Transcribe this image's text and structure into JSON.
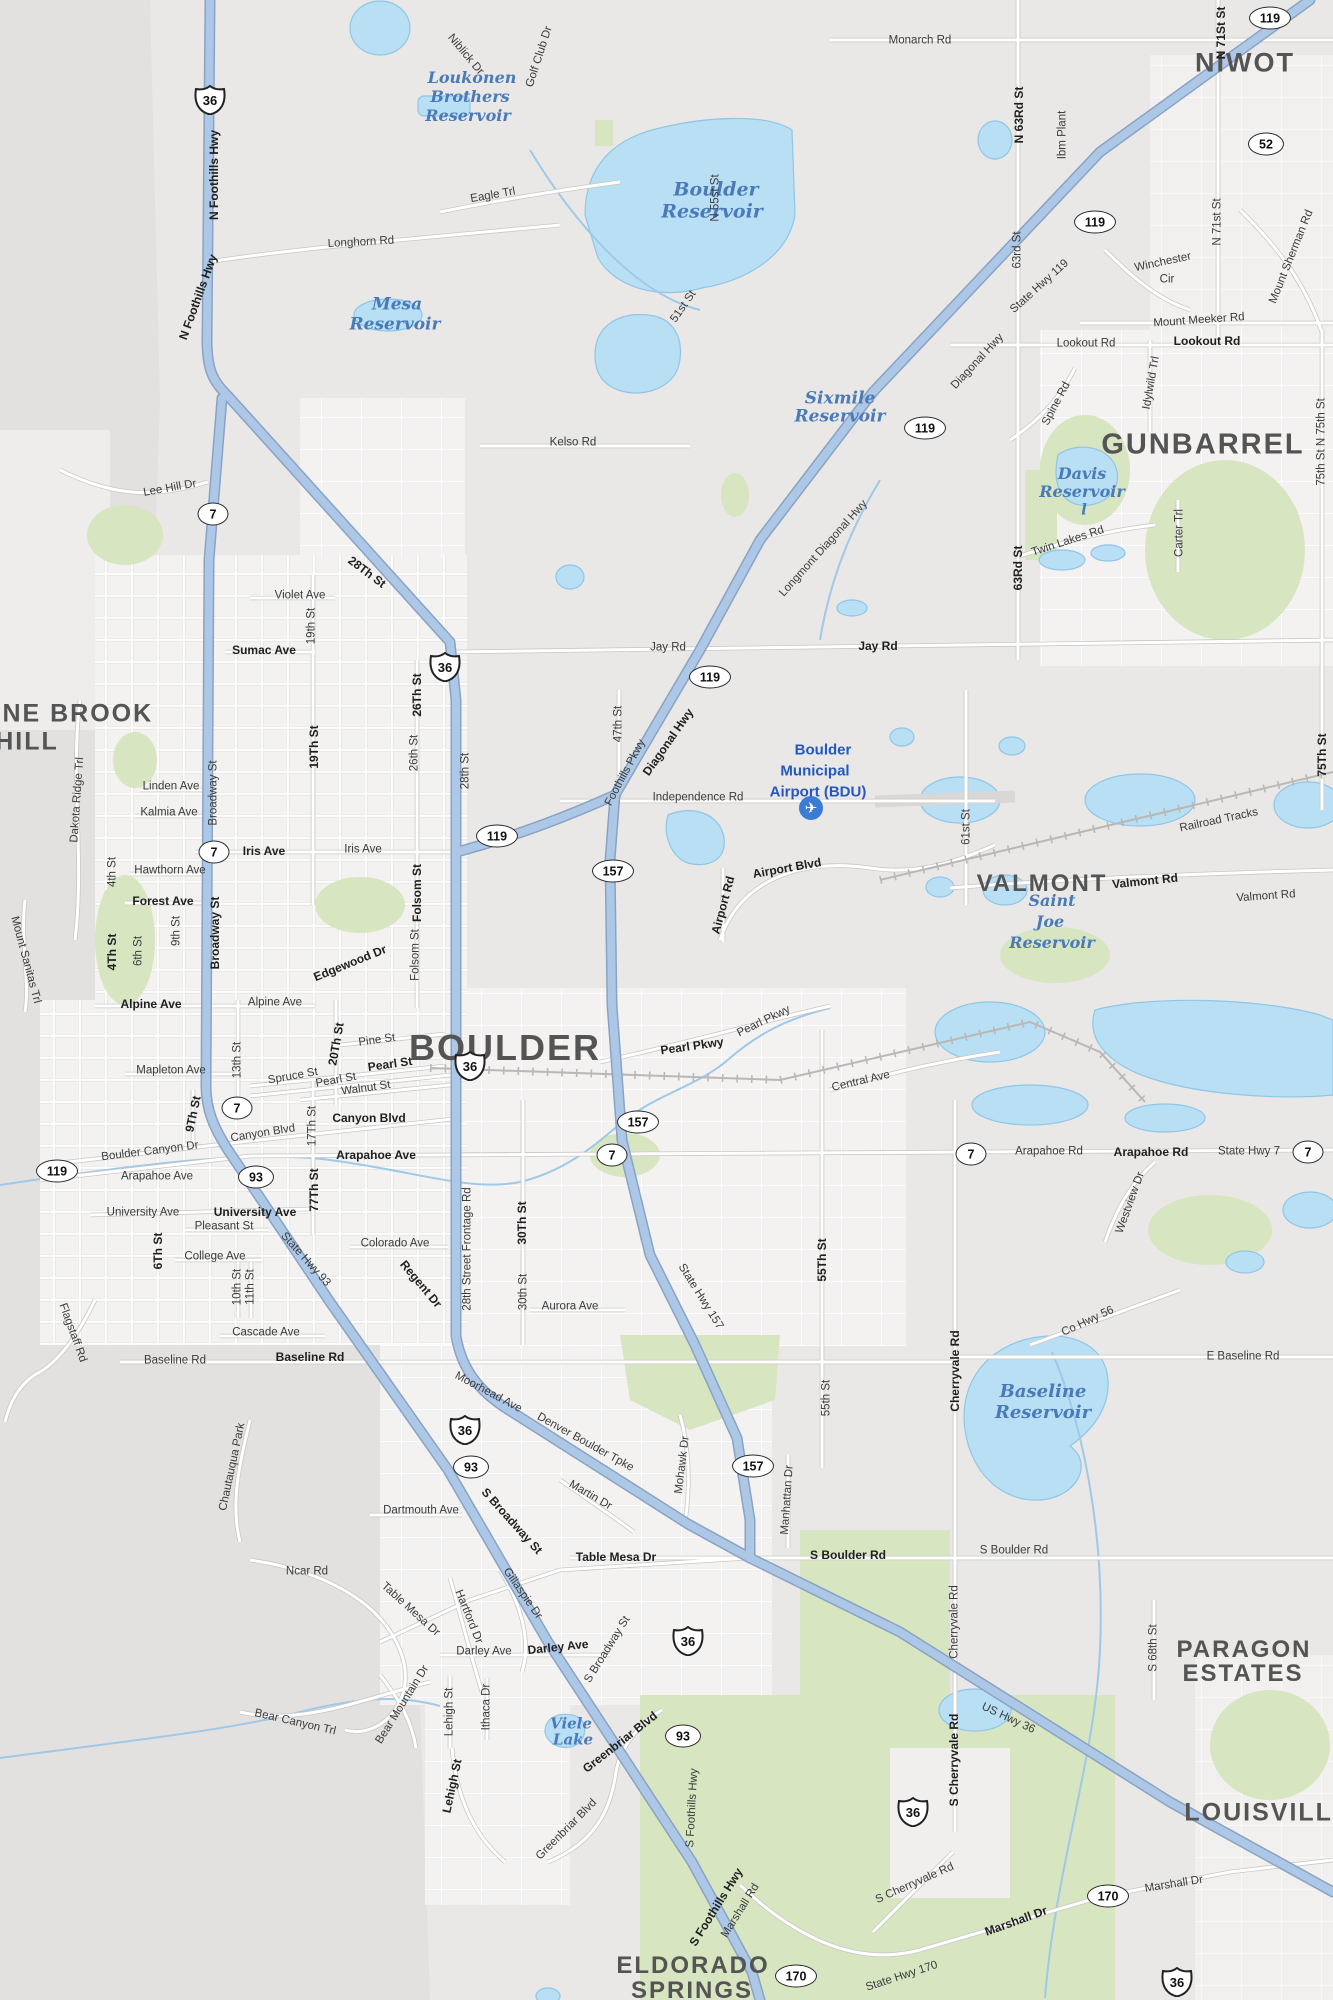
{
  "map_name": "Boulder, CO street map",
  "colors": {
    "base": "#e9e8e6",
    "mountain": "#e2e1df",
    "city": "#f3f2f0",
    "green": "#d7e5c1",
    "water_fill": "#b8dff4",
    "water_edge": "#8fc6e8",
    "road_fill": "#ffffff",
    "road_casing": "#c9c8c6",
    "highway_fill": "#adc7e6",
    "highway_casing": "#8aa3c4",
    "rail": "#b9b8b6",
    "label": "#3b3b3b",
    "place": "#545454",
    "water_label": "#4a7ab8",
    "airport_blue": "#2458c0"
  },
  "airport": {
    "icon": "airplane-icon",
    "x": 811,
    "y": 808,
    "lines": [
      {
        "t": "Boulder",
        "x": 823,
        "y": 750
      },
      {
        "t": "Municipal",
        "x": 815,
        "y": 771
      },
      {
        "t": "Airport (BDU)",
        "x": 818,
        "y": 792
      }
    ]
  },
  "place_labels": [
    {
      "t": "NIWOT",
      "x": 1245,
      "y": 63,
      "s": 27
    },
    {
      "t": "GUNBARREL",
      "x": 1203,
      "y": 445,
      "s": 29
    },
    {
      "t": "PINE BROOK",
      "x": 64,
      "y": 714,
      "s": 25
    },
    {
      "t": "HILL",
      "x": 27,
      "y": 742,
      "s": 25
    },
    {
      "t": "VALMONT",
      "x": 1042,
      "y": 884,
      "s": 24
    },
    {
      "t": "BOULDER",
      "x": 505,
      "y": 1048,
      "s": 36
    },
    {
      "t": "PARAGON",
      "x": 1244,
      "y": 1650,
      "s": 24
    },
    {
      "t": "ESTATES",
      "x": 1243,
      "y": 1674,
      "s": 24
    },
    {
      "t": "LOUISVILLE",
      "x": 1268,
      "y": 1813,
      "s": 25
    },
    {
      "t": "ELDORADO",
      "x": 693,
      "y": 1966,
      "s": 24
    },
    {
      "t": "SPRINGS",
      "x": 692,
      "y": 1991,
      "s": 24
    }
  ],
  "water_labels": [
    {
      "t": "Loukonen",
      "x": 472,
      "y": 78,
      "s": 16
    },
    {
      "t": "Brothers",
      "x": 470,
      "y": 97,
      "s": 16
    },
    {
      "t": "Reservoir",
      "x": 468,
      "y": 116,
      "s": 16
    },
    {
      "t": "Boulder",
      "x": 716,
      "y": 190,
      "s": 19
    },
    {
      "t": "Reservoir",
      "x": 712,
      "y": 212,
      "s": 19
    },
    {
      "t": "Mesa",
      "x": 397,
      "y": 305,
      "s": 17
    },
    {
      "t": "Reservoir",
      "x": 395,
      "y": 325,
      "s": 17
    },
    {
      "t": "Sixmile",
      "x": 840,
      "y": 399,
      "s": 17
    },
    {
      "t": "Reservoir",
      "x": 840,
      "y": 417,
      "s": 17
    },
    {
      "t": "Davis",
      "x": 1082,
      "y": 474,
      "s": 16
    },
    {
      "t": "Reservoir",
      "x": 1082,
      "y": 492,
      "s": 16
    },
    {
      "t": "l",
      "x": 1084,
      "y": 510,
      "s": 15
    },
    {
      "t": "Saint",
      "x": 1052,
      "y": 901,
      "s": 16
    },
    {
      "t": "Joe",
      "x": 1050,
      "y": 922,
      "s": 16
    },
    {
      "t": "Reservoir",
      "x": 1052,
      "y": 943,
      "s": 16
    },
    {
      "t": "Baseline",
      "x": 1043,
      "y": 1392,
      "s": 18
    },
    {
      "t": "Reservoir",
      "x": 1043,
      "y": 1413,
      "s": 18
    },
    {
      "t": "Viele",
      "x": 571,
      "y": 1724,
      "s": 15
    },
    {
      "t": "Lake",
      "x": 573,
      "y": 1740,
      "s": 15
    }
  ],
  "road_labels": [
    {
      "t": "N Foothills Hwy",
      "x": 214,
      "y": 175,
      "r": -90,
      "b": 1
    },
    {
      "t": "N Foothills Hwy",
      "x": 198,
      "y": 297,
      "r": -70,
      "b": 1
    },
    {
      "t": "Longhorn Rd",
      "x": 361,
      "y": 243,
      "r": -3
    },
    {
      "t": "Monarch Rd",
      "x": 920,
      "y": 41
    },
    {
      "t": "Niblick Dr",
      "x": 465,
      "y": 55,
      "r": 50
    },
    {
      "t": "Golf Club Dr",
      "x": 540,
      "y": 57,
      "r": -72
    },
    {
      "t": "Eagle Trl",
      "x": 493,
      "y": 196,
      "r": -10
    },
    {
      "t": "N 55st St",
      "x": 716,
      "y": 198,
      "r": -90
    },
    {
      "t": "51st St",
      "x": 684,
      "y": 307,
      "r": -55
    },
    {
      "t": "Kelso Rd",
      "x": 573,
      "y": 443
    },
    {
      "t": "N 63Rd St",
      "x": 1019,
      "y": 115,
      "r": -90,
      "b": 1
    },
    {
      "t": "63rd St",
      "x": 1018,
      "y": 250,
      "r": -90
    },
    {
      "t": "Ibm Plant",
      "x": 1063,
      "y": 135,
      "r": -90
    },
    {
      "t": "N 71St St",
      "x": 1221,
      "y": 33,
      "r": -90,
      "b": 1
    },
    {
      "t": "N 71st St",
      "x": 1218,
      "y": 222,
      "r": -90
    },
    {
      "t": "State Hwy 119",
      "x": 1040,
      "y": 287,
      "r": -42
    },
    {
      "t": "Winchester",
      "x": 1163,
      "y": 263,
      "r": -12
    },
    {
      "t": "Cir",
      "x": 1167,
      "y": 280
    },
    {
      "t": "Mount Meeker Rd",
      "x": 1199,
      "y": 321,
      "r": -4
    },
    {
      "t": "Mount Sherman Rd",
      "x": 1292,
      "y": 257,
      "r": -68
    },
    {
      "t": "Lookout Rd",
      "x": 1086,
      "y": 344
    },
    {
      "t": "Lookout Rd",
      "x": 1207,
      "y": 341,
      "b": 1
    },
    {
      "t": "Diagonal Hwy",
      "x": 978,
      "y": 362,
      "r": -47
    },
    {
      "t": "Spine Rd",
      "x": 1057,
      "y": 404,
      "r": -62
    },
    {
      "t": "Idylwild Trl",
      "x": 1152,
      "y": 383,
      "r": -80
    },
    {
      "t": "Carter Trl",
      "x": 1180,
      "y": 533,
      "r": -90
    },
    {
      "t": "63Rd St",
      "x": 1018,
      "y": 568,
      "r": -90,
      "b": 1
    },
    {
      "t": "Twin Lakes Rd",
      "x": 1068,
      "y": 542,
      "r": -18
    },
    {
      "t": "75th St  N 75th St",
      "x": 1322,
      "y": 442,
      "r": -90
    },
    {
      "t": "Jay Rd",
      "x": 668,
      "y": 648
    },
    {
      "t": "Jay Rd",
      "x": 878,
      "y": 646,
      "b": 1
    },
    {
      "t": "Longmont Diagonal Hwy",
      "x": 824,
      "y": 549,
      "r": -48
    },
    {
      "t": "Lee Hill Dr",
      "x": 170,
      "y": 489,
      "r": -10
    },
    {
      "t": "28Th St",
      "x": 367,
      "y": 572,
      "r": 37,
      "b": 1
    },
    {
      "t": "Violet Ave",
      "x": 300,
      "y": 596
    },
    {
      "t": "19th St",
      "x": 312,
      "y": 626,
      "r": -90
    },
    {
      "t": "Sumac Ave",
      "x": 264,
      "y": 650,
      "b": 1
    },
    {
      "t": "26Th St",
      "x": 417,
      "y": 695,
      "r": -90,
      "b": 1
    },
    {
      "t": "26th St",
      "x": 415,
      "y": 753,
      "r": -90
    },
    {
      "t": "Broadway St",
      "x": 214,
      "y": 793,
      "r": -90
    },
    {
      "t": "Broadway St",
      "x": 215,
      "y": 933,
      "r": -90,
      "b": 1
    },
    {
      "t": "Linden Ave",
      "x": 171,
      "y": 787
    },
    {
      "t": "Kalmia Ave",
      "x": 169,
      "y": 813
    },
    {
      "t": "Iris Ave",
      "x": 264,
      "y": 851,
      "b": 1
    },
    {
      "t": "Iris Ave",
      "x": 363,
      "y": 850
    },
    {
      "t": "19Th St",
      "x": 314,
      "y": 747,
      "r": -90,
      "b": 1
    },
    {
      "t": "Hawthorn Ave",
      "x": 170,
      "y": 871
    },
    {
      "t": "Forest Ave",
      "x": 163,
      "y": 901,
      "b": 1
    },
    {
      "t": "4th St",
      "x": 113,
      "y": 872,
      "r": -90
    },
    {
      "t": "4Th St",
      "x": 112,
      "y": 952,
      "r": -90,
      "b": 1
    },
    {
      "t": "6th St",
      "x": 139,
      "y": 951,
      "r": -90
    },
    {
      "t": "9th St",
      "x": 177,
      "y": 931,
      "r": -90
    },
    {
      "t": "Mount Sanitas Trl",
      "x": 25,
      "y": 960,
      "r": 75
    },
    {
      "t": "Dakota Ridge Trl",
      "x": 78,
      "y": 800,
      "r": -86
    },
    {
      "t": "Edgewood Dr",
      "x": 350,
      "y": 963,
      "r": -22,
      "b": 1
    },
    {
      "t": "Folsom St",
      "x": 417,
      "y": 893,
      "r": -90,
      "b": 1
    },
    {
      "t": "Folsom St",
      "x": 416,
      "y": 955,
      "r": -90
    },
    {
      "t": "Alpine Ave",
      "x": 151,
      "y": 1004,
      "b": 1
    },
    {
      "t": "Alpine Ave",
      "x": 275,
      "y": 1003
    },
    {
      "t": "Mapleton Ave",
      "x": 171,
      "y": 1071
    },
    {
      "t": "13th St",
      "x": 238,
      "y": 1060,
      "r": -90
    },
    {
      "t": "20Th St",
      "x": 336,
      "y": 1044,
      "r": -80,
      "b": 1
    },
    {
      "t": "Pine St",
      "x": 377,
      "y": 1041,
      "r": -8
    },
    {
      "t": "Spruce St",
      "x": 293,
      "y": 1077,
      "r": -10
    },
    {
      "t": "Pearl St",
      "x": 336,
      "y": 1081,
      "r": -10
    },
    {
      "t": "Pearl St",
      "x": 390,
      "y": 1064,
      "r": -8,
      "b": 1
    },
    {
      "t": "Walnut St",
      "x": 366,
      "y": 1089,
      "r": -8
    },
    {
      "t": "9Th St",
      "x": 193,
      "y": 1114,
      "r": -78,
      "b": 1
    },
    {
      "t": "Canyon Blvd",
      "x": 263,
      "y": 1134,
      "r": -9
    },
    {
      "t": "Canyon Blvd",
      "x": 369,
      "y": 1118,
      "b": 1
    },
    {
      "t": "Boulder Canyon Dr",
      "x": 150,
      "y": 1152,
      "r": -7
    },
    {
      "t": "Arapahoe Ave",
      "x": 157,
      "y": 1177
    },
    {
      "t": "Arapahoe Ave",
      "x": 376,
      "y": 1155,
      "b": 1
    },
    {
      "t": "17Th St",
      "x": 313,
      "y": 1126,
      "r": -90
    },
    {
      "t": "77Th St",
      "x": 314,
      "y": 1190,
      "r": -90,
      "b": 1
    },
    {
      "t": "University Ave",
      "x": 143,
      "y": 1213
    },
    {
      "t": "University Ave",
      "x": 255,
      "y": 1212,
      "b": 1
    },
    {
      "t": "Pleasant St",
      "x": 224,
      "y": 1227
    },
    {
      "t": "6Th St",
      "x": 158,
      "y": 1251,
      "r": -90,
      "b": 1
    },
    {
      "t": "College Ave",
      "x": 215,
      "y": 1257
    },
    {
      "t": "10th St",
      "x": 238,
      "y": 1287,
      "r": -90
    },
    {
      "t": "11th St",
      "x": 251,
      "y": 1287,
      "r": -90
    },
    {
      "t": "State Hwy 93",
      "x": 305,
      "y": 1260,
      "r": 48
    },
    {
      "t": "Colorado Ave",
      "x": 395,
      "y": 1244
    },
    {
      "t": "Regent Dr",
      "x": 421,
      "y": 1284,
      "r": 50,
      "b": 1
    },
    {
      "t": "Cascade Ave",
      "x": 266,
      "y": 1333
    },
    {
      "t": "Flagstaff Rd",
      "x": 72,
      "y": 1333,
      "r": 70
    },
    {
      "t": "State Hwy 93",
      "x": 300,
      "y": 1262,
      "r": 48,
      "hide": 1
    },
    {
      "t": "Pearl Pkwy",
      "x": 692,
      "y": 1046,
      "r": -8,
      "b": 1
    },
    {
      "t": "Pearl Pkwy",
      "x": 764,
      "y": 1022,
      "r": -26
    },
    {
      "t": "Central Ave",
      "x": 861,
      "y": 1082,
      "r": -13
    },
    {
      "t": "28th Street Frontage Rd",
      "x": 468,
      "y": 1249,
      "r": -90
    },
    {
      "t": "30Th St",
      "x": 522,
      "y": 1223,
      "r": -90,
      "b": 1
    },
    {
      "t": "30th St",
      "x": 524,
      "y": 1292,
      "r": -90
    },
    {
      "t": "Aurora Ave",
      "x": 570,
      "y": 1307
    },
    {
      "t": "State Hwy 157",
      "x": 700,
      "y": 1297,
      "r": 58
    },
    {
      "t": "55Th St",
      "x": 822,
      "y": 1260,
      "r": -90,
      "b": 1
    },
    {
      "t": "Valmont Rd",
      "x": 1145,
      "y": 881,
      "r": -6,
      "b": 1
    },
    {
      "t": "Valmont Rd",
      "x": 1266,
      "y": 897,
      "r": -4
    },
    {
      "t": "Railroad Tracks",
      "x": 1219,
      "y": 821,
      "r": -12
    },
    {
      "t": "61st St",
      "x": 967,
      "y": 827,
      "r": -90
    },
    {
      "t": "75Th St",
      "x": 1322,
      "y": 755,
      "r": -90,
      "b": 1
    },
    {
      "t": "Diagonal Hwy",
      "x": 668,
      "y": 742,
      "r": -55,
      "b": 1
    },
    {
      "t": "47th St",
      "x": 619,
      "y": 724,
      "r": -90
    },
    {
      "t": "Foothills Pkwy",
      "x": 626,
      "y": 773,
      "r": -62
    },
    {
      "t": "Independence Rd",
      "x": 698,
      "y": 798
    },
    {
      "t": "28th St",
      "x": 466,
      "y": 771,
      "r": -90
    },
    {
      "t": "Airport Rd",
      "x": 723,
      "y": 905,
      "r": -75,
      "b": 1
    },
    {
      "t": "Airport Blvd",
      "x": 787,
      "y": 868,
      "r": -10,
      "b": 1
    },
    {
      "t": "Arapahoe Rd",
      "x": 1049,
      "y": 1152
    },
    {
      "t": "Arapahoe Rd",
      "x": 1151,
      "y": 1152,
      "b": 1
    },
    {
      "t": "State Hwy 7",
      "x": 1249,
      "y": 1152
    },
    {
      "t": "Westview Dr",
      "x": 1131,
      "y": 1203,
      "r": -70
    },
    {
      "t": "Co Hwy 56",
      "x": 1088,
      "y": 1322,
      "r": -25
    },
    {
      "t": "Cherryvale Rd",
      "x": 955,
      "y": 1371,
      "r": -90,
      "b": 1
    },
    {
      "t": "Cherryvale Rd",
      "x": 955,
      "y": 1622,
      "r": -90
    },
    {
      "t": "E Baseline Rd",
      "x": 1243,
      "y": 1357
    },
    {
      "t": "S Boulder Rd",
      "x": 1014,
      "y": 1551
    },
    {
      "t": "S Boulder Rd",
      "x": 848,
      "y": 1555,
      "b": 1
    },
    {
      "t": "S 68th St",
      "x": 1154,
      "y": 1648,
      "r": -90
    },
    {
      "t": "Baseline Rd",
      "x": 175,
      "y": 1361
    },
    {
      "t": "Baseline Rd",
      "x": 310,
      "y": 1357,
      "b": 1
    },
    {
      "t": "Chautauqua Park",
      "x": 233,
      "y": 1467,
      "r": -78
    },
    {
      "t": "Dartmouth Ave",
      "x": 421,
      "y": 1511
    },
    {
      "t": "Ncar Rd",
      "x": 307,
      "y": 1572
    },
    {
      "t": "Table Mesa Dr",
      "x": 410,
      "y": 1610,
      "r": 42
    },
    {
      "t": "Moorhead Ave",
      "x": 488,
      "y": 1393,
      "r": 28
    },
    {
      "t": "Denver Boulder Tpke",
      "x": 585,
      "y": 1443,
      "r": 29
    },
    {
      "t": "Mohawk Dr",
      "x": 683,
      "y": 1465,
      "r": -83
    },
    {
      "t": "S Broadway St",
      "x": 512,
      "y": 1521,
      "r": 48,
      "b": 1
    },
    {
      "t": "Martin Dr",
      "x": 590,
      "y": 1496,
      "r": 30
    },
    {
      "t": "Manhattan Dr",
      "x": 788,
      "y": 1500,
      "r": -86
    },
    {
      "t": "55th St",
      "x": 827,
      "y": 1398,
      "r": -90
    },
    {
      "t": "Table Mesa Dr",
      "x": 616,
      "y": 1557,
      "b": 1
    },
    {
      "t": "Gillaspie Dr",
      "x": 522,
      "y": 1594,
      "r": 55
    },
    {
      "t": "Hartford Dr",
      "x": 468,
      "y": 1617,
      "r": 68
    },
    {
      "t": "Darley Ave",
      "x": 484,
      "y": 1652
    },
    {
      "t": "Darley Ave",
      "x": 558,
      "y": 1647,
      "r": -6,
      "b": 1
    },
    {
      "t": "S Broadway St",
      "x": 608,
      "y": 1650,
      "r": -58
    },
    {
      "t": "Bear Canyon Trl",
      "x": 295,
      "y": 1723,
      "r": 13
    },
    {
      "t": "Bear Mountain Dr",
      "x": 403,
      "y": 1705,
      "r": -58
    },
    {
      "t": "Lehigh St",
      "x": 450,
      "y": 1712,
      "r": -90
    },
    {
      "t": "Lehigh St",
      "x": 452,
      "y": 1786,
      "r": -78,
      "b": 1
    },
    {
      "t": "Ithaca Dr",
      "x": 487,
      "y": 1707,
      "r": -90
    },
    {
      "t": "Greenbriar Blvd",
      "x": 620,
      "y": 1742,
      "r": -38,
      "b": 1
    },
    {
      "t": "Greenbriar Blvd",
      "x": 567,
      "y": 1830,
      "r": -45
    },
    {
      "t": "S Foothills Hwy",
      "x": 693,
      "y": 1808,
      "r": -87
    },
    {
      "t": "S Foothills Hwy",
      "x": 716,
      "y": 1907,
      "r": -58,
      "b": 1
    },
    {
      "t": "Marshall Rd",
      "x": 741,
      "y": 1911,
      "r": -58
    },
    {
      "t": "State Hwy 170",
      "x": 902,
      "y": 1977,
      "r": -18
    },
    {
      "t": "S Cherryvale Rd",
      "x": 915,
      "y": 1884,
      "r": -24
    },
    {
      "t": "US Hwy 36",
      "x": 1008,
      "y": 1719,
      "r": 25
    },
    {
      "t": "S Cherryvale Rd",
      "x": 954,
      "y": 1760,
      "r": -90,
      "b": 1
    },
    {
      "t": "Marshall Dr",
      "x": 1174,
      "y": 1885,
      "r": -9
    },
    {
      "t": "Marshall Dr",
      "x": 1016,
      "y": 1921,
      "r": -20,
      "b": 1
    }
  ],
  "shields": [
    {
      "n": "36",
      "t": "us",
      "x": 210,
      "y": 100
    },
    {
      "n": "36",
      "t": "us",
      "x": 445,
      "y": 637
    },
    {
      "n": "36",
      "t": "us",
      "x": 470,
      "y": 1006
    },
    {
      "n": "36",
      "t": "us",
      "x": 465,
      "y": 1340
    },
    {
      "n": "36",
      "t": "us",
      "x": 688,
      "y": 1521
    },
    {
      "n": "36",
      "t": "us",
      "x": 913,
      "y": 1662
    },
    {
      "n": "36",
      "t": "us",
      "x": 1177,
      "y": 1802
    },
    {
      "n": "119",
      "t": "ov",
      "x": 1270,
      "y": 18
    },
    {
      "n": "119",
      "t": "ov",
      "x": 1095,
      "y": 222
    },
    {
      "n": "119",
      "t": "ov",
      "x": 925,
      "y": 428
    },
    {
      "n": "119",
      "t": "ov",
      "x": 710,
      "y": 677
    },
    {
      "n": "119",
      "t": "ov",
      "x": 497,
      "y": 836
    },
    {
      "n": "119",
      "t": "ov",
      "x": 57,
      "y": 1171
    },
    {
      "n": "52",
      "t": "ov",
      "x": 1266,
      "y": 144
    },
    {
      "n": "7",
      "t": "ov",
      "x": 213,
      "y": 514
    },
    {
      "n": "7",
      "t": "ov",
      "x": 214,
      "y": 852
    },
    {
      "n": "7",
      "t": "ov",
      "x": 237,
      "y": 1108
    },
    {
      "n": "7",
      "t": "ov",
      "x": 612,
      "y": 1155
    },
    {
      "n": "7",
      "t": "ov",
      "x": 971,
      "y": 1154
    },
    {
      "n": "7",
      "t": "ov",
      "x": 1308,
      "y": 1152
    },
    {
      "n": "157",
      "t": "ov",
      "x": 613,
      "y": 871
    },
    {
      "n": "157",
      "t": "ov",
      "x": 638,
      "y": 1122
    },
    {
      "n": "157",
      "t": "ov",
      "x": 753,
      "y": 1466
    },
    {
      "n": "93",
      "t": "ov",
      "x": 256,
      "y": 1177
    },
    {
      "n": "93",
      "t": "ov",
      "x": 471,
      "y": 1467
    },
    {
      "n": "93",
      "t": "ov",
      "x": 683,
      "y": 1736
    },
    {
      "n": "170",
      "t": "ov",
      "x": 796,
      "y": 1976
    },
    {
      "n": "170",
      "t": "ov",
      "x": 1108,
      "y": 1896
    }
  ]
}
